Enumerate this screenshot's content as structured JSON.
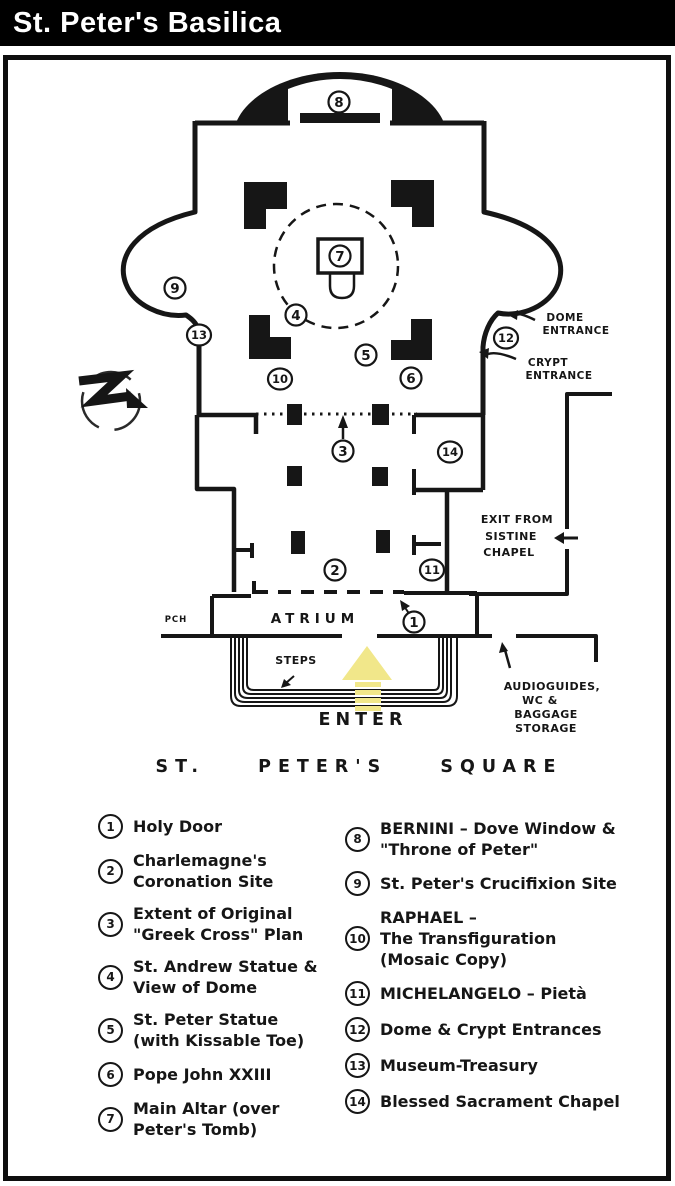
{
  "title_bar": {
    "title": "St. Peter's Basilica"
  },
  "colors": {
    "title_bg": "#000000",
    "title_fg": "#ffffff",
    "ink": "#161616",
    "enter_arrow_yellow": "#f1e78a",
    "background": "#ffffff"
  },
  "map": {
    "markers": [
      "1",
      "2",
      "3",
      "4",
      "5",
      "6",
      "7",
      "8",
      "9",
      "10",
      "11",
      "12",
      "13",
      "14"
    ],
    "labels": {
      "atrium": "ATRIUM",
      "porch": "PCH",
      "steps": "STEPS",
      "enter": "ENTER",
      "square": "ST. PETER'S SQUARE",
      "dome_entrance": [
        "DOME",
        "ENTRANCE"
      ],
      "crypt_entrance": [
        "CRYPT",
        "ENTRANCE"
      ],
      "sistine_exit": [
        "EXIT FROM",
        "SISTINE",
        "CHAPEL"
      ],
      "audioguides": [
        "AUDIOGUIDES,",
        "WC &",
        "BAGGAGE",
        "STORAGE"
      ]
    },
    "icons": [
      "north-compass-icon",
      "enter-arrow-icon"
    ]
  },
  "legend": {
    "items": [
      {
        "number": "1",
        "text": "Holy Door"
      },
      {
        "number": "2",
        "text": "Charlemagne's\nCoronation Site"
      },
      {
        "number": "3",
        "text": "Extent of Original\n\"Greek Cross\" Plan"
      },
      {
        "number": "4",
        "text": "St. Andrew Statue &\nView of Dome"
      },
      {
        "number": "5",
        "text": "St. Peter Statue\n(with Kissable Toe)"
      },
      {
        "number": "6",
        "text": "Pope John XXIII"
      },
      {
        "number": "7",
        "text": "Main Altar (over\nPeter's Tomb)"
      },
      {
        "number": "8",
        "text": "BERNINI – Dove Window &\n\"Throne of Peter\""
      },
      {
        "number": "9",
        "text": "St. Peter's Crucifixion Site"
      },
      {
        "number": "10",
        "text": "RAPHAEL –\nThe Transfiguration\n(Mosaic Copy)"
      },
      {
        "number": "11",
        "text": "MICHELANGELO – Pietà"
      },
      {
        "number": "12",
        "text": "Dome & Crypt Entrances"
      },
      {
        "number": "13",
        "text": "Museum-Treasury"
      },
      {
        "number": "14",
        "text": "Blessed Sacrament Chapel"
      }
    ]
  }
}
